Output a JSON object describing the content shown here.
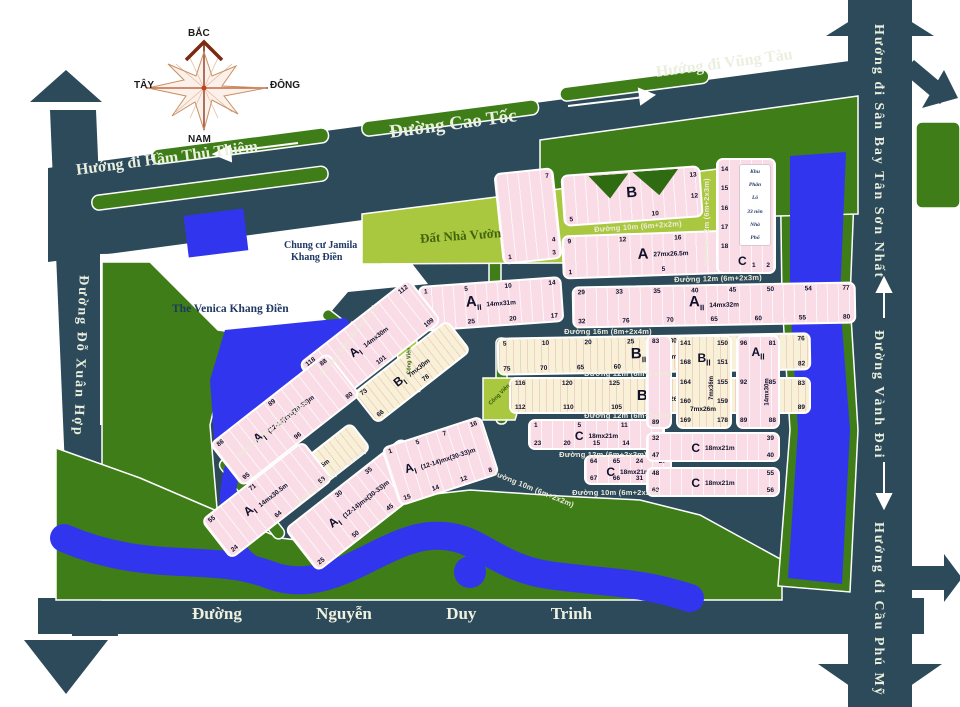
{
  "colors": {
    "road": "#2c4a5a",
    "green": "#3e7d17",
    "park": "#a9c83f",
    "water": "#3136ee",
    "block_pink": "#f9dce6",
    "block_cream": "#f8f1d7",
    "label_navy": "#1f3864",
    "street_text": "#efeadb"
  },
  "compass": {
    "n": "BẮC",
    "s": "NAM",
    "w": "TÂY",
    "e": "ĐÔNG"
  },
  "roads": {
    "cao_toc": "Đường Cao Tốc",
    "ham_thu_thiem": "Hướng đi Hầm Thủ Thiêm",
    "vung_tau": "Hướng đi Vũng Tàu",
    "do_xuan_hop": "Đường Đỗ Xuân Hợp",
    "san_bay": "Hướng đi Sân Bay Tân Sơn Nhất",
    "vanh_dai": "Đường Vành Đai",
    "cau_phu_my": "Hướng đi Cầu Phú Mỹ",
    "nguyen_duy_trinh": [
      "Đường",
      "Nguyễn",
      "Duy",
      "Trinh"
    ]
  },
  "streets": {
    "s1": "Đường 10m (6m+2x2m)",
    "s2": "Đường 12m (6m+2x3m)",
    "s3": "Đường 16m (8m+2x4m)",
    "s4": "Đường 12m (6m+2x3m)",
    "s5": "Đường 12m (6m+2x3m)",
    "s6": "Đường 12m (6m+2x3m)",
    "s7": "Đường 10m (6m+2x2m)",
    "sv1": "Đường 12m (6m+2x3m)",
    "sa1": "Đường 10m (6m+2x2m)",
    "sa2": "Đường 16m (8m+2x4m)",
    "sa3": "Đường 12m (6m+2x3m)",
    "sa4": "Đường 10m (6m+2x2m)"
  },
  "areas": {
    "dat_nha_vuon": "Đất Nhà Vườn",
    "jamila_1": "Chung cư Jamila",
    "jamila_2": "Khang Điền",
    "venica": "The Venica Khang Điền",
    "khu_phan_lo": [
      "Khu",
      "Phân",
      "Lô",
      "33 nền",
      "Nhà",
      "Phố"
    ],
    "cong_vien": "Công Viên"
  },
  "blocks": {
    "b_strip": {
      "col": [
        7,
        4
      ],
      "bottom": [
        1,
        3
      ]
    },
    "b_top": {
      "label": "B",
      "bottom": [
        5,
        10
      ],
      "right": [
        13,
        12
      ]
    },
    "a_top": {
      "label": "A",
      "dim": "27mx26.5m",
      "top": [
        9,
        12,
        16
      ],
      "bottom": [
        1,
        5,
        8
      ]
    },
    "aii_l": {
      "label": "A",
      "sub": "II",
      "dim": "14mx31m",
      "top": [
        1,
        5,
        10,
        14
      ],
      "bottom": [
        28,
        25,
        20,
        17
      ]
    },
    "aii_r": {
      "label": "A",
      "sub": "II",
      "dim": "14mx32m",
      "top": [
        29,
        33,
        35,
        40,
        45,
        50,
        54,
        77
      ],
      "bottom": [
        32,
        76,
        70,
        65,
        60,
        55,
        80
      ]
    },
    "bii_1": {
      "label": "B",
      "sub": "II",
      "dim": "7mx26m",
      "top": [
        5,
        10,
        20,
        25,
        30,
        35,
        38,
        76
      ],
      "bottom": [
        75,
        70,
        65,
        60,
        55,
        50,
        45,
        39,
        82
      ]
    },
    "bii_2": {
      "label": "B",
      "sub": "II",
      "dim": "7mx26m",
      "top": [
        116,
        120,
        125,
        130,
        135,
        140,
        83
      ],
      "bottom": [
        112,
        110,
        105,
        100,
        95,
        90,
        89
      ]
    },
    "c1": {
      "label": "C",
      "dim": "18mx21m",
      "top": [
        1,
        5,
        11
      ],
      "bottom": [
        23,
        20,
        15,
        14,
        12
      ]
    },
    "c2": {
      "label": "C",
      "dim": "18mx21m",
      "top": [
        64,
        65,
        24,
        27
      ],
      "bottom": [
        67,
        66,
        31,
        28
      ]
    },
    "strip_r": {
      "top": [
        83
      ],
      "bottom": [
        89
      ]
    },
    "bii_r": {
      "label": "B",
      "sub": "II",
      "dim_v": "7mx36m",
      "dim": "7mx26m",
      "left": [
        141,
        168,
        164,
        160,
        169
      ],
      "right": [
        150,
        151,
        155,
        159,
        178
      ]
    },
    "aii_r2": {
      "label": "A",
      "sub": "II",
      "dim_v": "14mx30m",
      "left": [
        96,
        92,
        89
      ],
      "right": [
        81,
        85,
        88
      ]
    },
    "c3": {
      "label": "C",
      "dim": "18mx21m",
      "top": [
        32,
        39
      ],
      "bottom": [
        47,
        40
      ]
    },
    "c4": {
      "label": "C",
      "dim": "18mx21m",
      "top": [
        48,
        55
      ],
      "bottom": [
        63,
        56
      ]
    },
    "c_top": {
      "label": "C",
      "left": [
        14,
        15,
        16,
        17,
        18
      ],
      "bottom": [
        1,
        2
      ]
    },
    "ai_a": {
      "label": "A",
      "sub": "I",
      "dim": "14mx30m",
      "top": [
        118,
        112
      ],
      "bottom": [
        99,
        101,
        109
      ]
    },
    "bi_a": {
      "label": "B",
      "sub": "I",
      "dim": "7mx30m",
      "top": [
        73
      ],
      "bottom": [
        66,
        78
      ]
    },
    "ai_b": {
      "label": "A",
      "sub": "I",
      "dim": "(12-14)mx(30-33)m",
      "top": [
        86,
        89,
        88
      ],
      "bottom": [
        95,
        96,
        80
      ]
    },
    "bi_b": {
      "label": "B",
      "sub": "I",
      "dim": "7mx30.5m"
    },
    "ai_c": {
      "label": "A",
      "sub": "I",
      "dim": "14mx30.5m",
      "top": [
        55,
        71
      ],
      "bottom": [
        24,
        64,
        53
      ]
    },
    "ai_d": {
      "label": "A",
      "sub": "I",
      "dim": "(12-14)mx(30-33)m",
      "top": [
        30,
        35,
        38
      ],
      "bottom": [
        25,
        50,
        45,
        40
      ]
    },
    "ai_e": {
      "label": "A",
      "sub": "I",
      "dim": "(12-14)mx(30-33)m",
      "top": [
        1,
        5,
        7,
        16
      ],
      "bottom": [
        15,
        14,
        12,
        8
      ]
    }
  }
}
